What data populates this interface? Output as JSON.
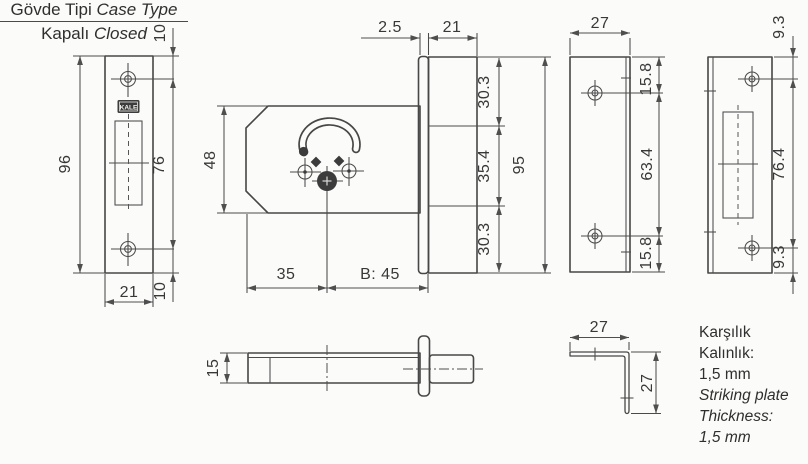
{
  "drawing": {
    "brand": "KALE",
    "faceplate": {
      "height": "96",
      "hole_span": "76",
      "offset_top": "10",
      "offset_bottom": "10",
      "width": "21"
    },
    "case": {
      "height": "48",
      "face_thickness": "2.5",
      "bolt_width": "21",
      "seg_top": "30.3",
      "seg_mid": "35.4",
      "seg_bottom": "30.3",
      "overall_height": "95",
      "dim_left": "35",
      "backset": "B: 45"
    },
    "case_side": {
      "thickness": "15"
    },
    "striker_side": {
      "width": "27",
      "seg_top": "15.8",
      "seg_mid": "63.4",
      "seg_bottom": "15.8"
    },
    "striker_front": {
      "offset_top": "9.3",
      "hole_span": "76.4",
      "offset_bottom": "9.3"
    },
    "angle_bracket": {
      "width": "27",
      "height": "27"
    }
  },
  "notes": {
    "case_type_tr": "Gövde Tipi",
    "case_type_en": "Case Type",
    "case_value_tr": "Kapalı",
    "case_value_en": "Closed",
    "striker_tr": [
      "Karşılık",
      "Kalınlık:",
      "1,5 mm"
    ],
    "striker_en": [
      "Striking plate",
      "Thickness:",
      "1,5 mm"
    ]
  },
  "colors": {
    "background": "#fbfbf9",
    "line": "#474747",
    "text": "#333333"
  }
}
